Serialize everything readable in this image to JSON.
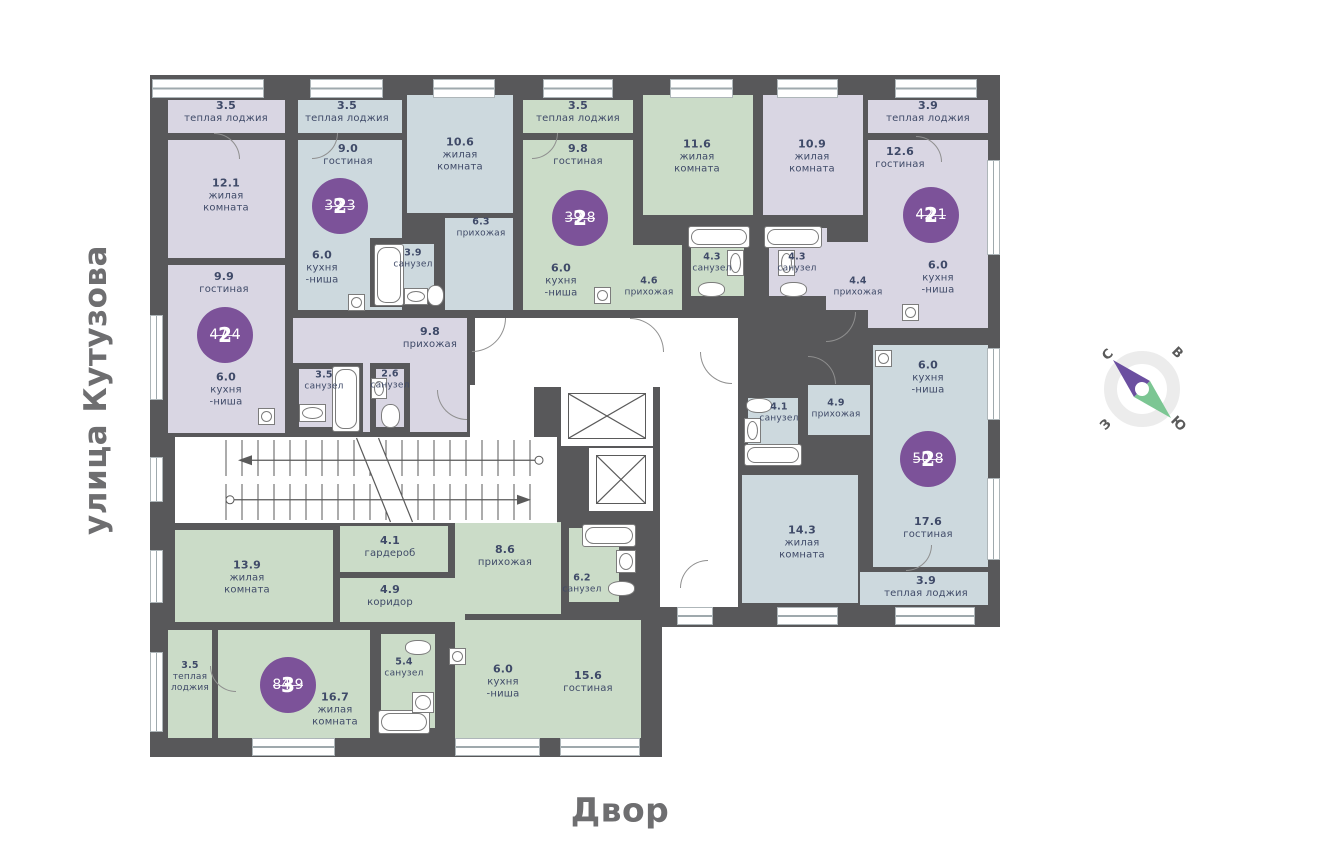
{
  "labels": {
    "street": "улица Кутузова",
    "courtyard": "Двор"
  },
  "compass": {
    "n": "С",
    "e": "В",
    "s": "Ю",
    "w": "З"
  },
  "colors": {
    "wall": "#58585a",
    "L": "#d9d6e3",
    "B": "#cdd9de",
    "G": "#cbdcc8",
    "W": "#ffffff",
    "badge": "#7c5299",
    "text": "#3f4a68",
    "street_text": "#6e6e70",
    "needle_north": "#6b4fa0",
    "needle_south": "#7cc693"
  },
  "apartments": [
    {
      "rooms": "2",
      "area": "47.4",
      "x": 225,
      "y": 335
    },
    {
      "rooms": "2",
      "area": "39.3",
      "x": 340,
      "y": 206
    },
    {
      "rooms": "2",
      "area": "39.8",
      "x": 580,
      "y": 218
    },
    {
      "rooms": "2",
      "area": "42.1",
      "x": 931,
      "y": 215
    },
    {
      "rooms": "2",
      "area": "50.8",
      "x": 928,
      "y": 459
    },
    {
      "rooms": "3",
      "area": "84.9",
      "x": 288,
      "y": 685
    }
  ],
  "building_blocks": [
    {
      "x": 150,
      "y": 75,
      "w": 850,
      "h": 552
    },
    {
      "x": 150,
      "y": 520,
      "w": 512,
      "h": 237
    }
  ],
  "rooms": [
    {
      "x": 168,
      "y": 100,
      "w": 117,
      "h": 33,
      "c": "L"
    },
    {
      "x": 168,
      "y": 140,
      "w": 117,
      "h": 118,
      "c": "L"
    },
    {
      "x": 168,
      "y": 265,
      "w": 117,
      "h": 168,
      "c": "L"
    },
    {
      "x": 293,
      "y": 318,
      "w": 174,
      "h": 114,
      "c": "L"
    },
    {
      "x": 293,
      "y": 363,
      "w": 70,
      "h": 70,
      "c": "L",
      "b": 1
    },
    {
      "x": 370,
      "y": 363,
      "w": 40,
      "h": 70,
      "c": "L",
      "b": 1
    },
    {
      "x": 763,
      "y": 95,
      "w": 100,
      "h": 120,
      "c": "L"
    },
    {
      "x": 763,
      "y": 222,
      "w": 70,
      "h": 80,
      "c": "L",
      "b": 1
    },
    {
      "x": 826,
      "y": 242,
      "w": 66,
      "h": 68,
      "c": "L"
    },
    {
      "x": 868,
      "y": 100,
      "w": 120,
      "h": 33,
      "c": "L"
    },
    {
      "x": 868,
      "y": 140,
      "w": 120,
      "h": 188,
      "c": "L"
    },
    {
      "x": 298,
      "y": 100,
      "w": 104,
      "h": 33,
      "c": "B"
    },
    {
      "x": 298,
      "y": 140,
      "w": 104,
      "h": 170,
      "c": "B"
    },
    {
      "x": 407,
      "y": 95,
      "w": 106,
      "h": 118,
      "c": "B"
    },
    {
      "x": 445,
      "y": 218,
      "w": 68,
      "h": 92,
      "c": "B"
    },
    {
      "x": 370,
      "y": 238,
      "w": 70,
      "h": 69,
      "c": "B",
      "b": 1
    },
    {
      "x": 873,
      "y": 345,
      "w": 115,
      "h": 222,
      "c": "B"
    },
    {
      "x": 808,
      "y": 385,
      "w": 62,
      "h": 50,
      "c": "B"
    },
    {
      "x": 742,
      "y": 392,
      "w": 62,
      "h": 76,
      "c": "B",
      "b": 1
    },
    {
      "x": 742,
      "y": 475,
      "w": 116,
      "h": 128,
      "c": "B"
    },
    {
      "x": 860,
      "y": 572,
      "w": 128,
      "h": 33,
      "c": "B"
    },
    {
      "x": 523,
      "y": 100,
      "w": 110,
      "h": 33,
      "c": "G"
    },
    {
      "x": 523,
      "y": 140,
      "w": 110,
      "h": 170,
      "c": "G"
    },
    {
      "x": 643,
      "y": 95,
      "w": 110,
      "h": 120,
      "c": "G"
    },
    {
      "x": 685,
      "y": 222,
      "w": 65,
      "h": 80,
      "c": "G",
      "b": 1
    },
    {
      "x": 610,
      "y": 245,
      "w": 72,
      "h": 65,
      "c": "G"
    },
    {
      "x": 175,
      "y": 530,
      "w": 158,
      "h": 92,
      "c": "G"
    },
    {
      "x": 340,
      "y": 526,
      "w": 108,
      "h": 46,
      "c": "G"
    },
    {
      "x": 340,
      "y": 578,
      "w": 125,
      "h": 44,
      "c": "G"
    },
    {
      "x": 168,
      "y": 630,
      "w": 44,
      "h": 108,
      "c": "G"
    },
    {
      "x": 218,
      "y": 630,
      "w": 152,
      "h": 108,
      "c": "G"
    },
    {
      "x": 375,
      "y": 628,
      "w": 66,
      "h": 106,
      "c": "G",
      "b": 1
    },
    {
      "x": 455,
      "y": 522,
      "w": 106,
      "h": 92,
      "c": "G"
    },
    {
      "x": 563,
      "y": 522,
      "w": 62,
      "h": 86,
      "c": "G",
      "b": 1
    },
    {
      "x": 455,
      "y": 620,
      "w": 186,
      "h": 118,
      "c": "G"
    },
    {
      "x": 475,
      "y": 318,
      "w": 263,
      "h": 69,
      "c": "W"
    },
    {
      "x": 470,
      "y": 385,
      "w": 64,
      "h": 52,
      "c": "W"
    },
    {
      "x": 175,
      "y": 437,
      "w": 382,
      "h": 86,
      "c": "W"
    },
    {
      "x": 660,
      "y": 387,
      "w": 78,
      "h": 220,
      "c": "W"
    }
  ],
  "room_labels": [
    {
      "x": 226,
      "y": 112,
      "area": "3.5",
      "name": "теплая лоджия"
    },
    {
      "x": 226,
      "y": 196,
      "area": "12.1",
      "name": "жилая\nкомната"
    },
    {
      "x": 224,
      "y": 283,
      "area": "9.9",
      "name": "гостиная"
    },
    {
      "x": 226,
      "y": 390,
      "area": "6.0",
      "name": "кухня\n-ниша"
    },
    {
      "x": 430,
      "y": 338,
      "area": "9.8",
      "name": "прихожая"
    },
    {
      "x": 324,
      "y": 381,
      "area": "3.5",
      "name": "санузел",
      "s": 1
    },
    {
      "x": 390,
      "y": 380,
      "area": "2.6",
      "name": "санузел",
      "s": 1
    },
    {
      "x": 347,
      "y": 112,
      "area": "3.5",
      "name": "теплая лоджия"
    },
    {
      "x": 348,
      "y": 155,
      "area": "9.0",
      "name": "гостиная"
    },
    {
      "x": 322,
      "y": 268,
      "area": "6.0",
      "name": "кухня\n-ниша"
    },
    {
      "x": 413,
      "y": 259,
      "area": "3.9",
      "name": "санузел",
      "s": 1
    },
    {
      "x": 460,
      "y": 155,
      "area": "10.6",
      "name": "жилая\nкомната"
    },
    {
      "x": 481,
      "y": 228,
      "area": "6.3",
      "name": "прихожая",
      "s": 1
    },
    {
      "x": 578,
      "y": 112,
      "area": "3.5",
      "name": "теплая лоджия"
    },
    {
      "x": 578,
      "y": 155,
      "area": "9.8",
      "name": "гостиная"
    },
    {
      "x": 561,
      "y": 281,
      "area": "6.0",
      "name": "кухня\n-ниша"
    },
    {
      "x": 649,
      "y": 287,
      "area": "4.6",
      "name": "прихожая",
      "s": 1
    },
    {
      "x": 712,
      "y": 263,
      "area": "4.3",
      "name": "санузел",
      "s": 1
    },
    {
      "x": 697,
      "y": 157,
      "area": "11.6",
      "name": "жилая\nкомната"
    },
    {
      "x": 812,
      "y": 157,
      "area": "10.9",
      "name": "жилая\nкомната"
    },
    {
      "x": 797,
      "y": 263,
      "area": "4.3",
      "name": "санузел",
      "s": 1
    },
    {
      "x": 858,
      "y": 287,
      "area": "4.4",
      "name": "прихожая",
      "s": 1
    },
    {
      "x": 928,
      "y": 112,
      "area": "3.9",
      "name": "теплая лоджия"
    },
    {
      "x": 900,
      "y": 158,
      "area": "12.6",
      "name": "гостиная"
    },
    {
      "x": 938,
      "y": 278,
      "area": "6.0",
      "name": "кухня\n-ниша"
    },
    {
      "x": 928,
      "y": 378,
      "area": "6.0",
      "name": "кухня\n-ниша"
    },
    {
      "x": 836,
      "y": 409,
      "area": "4.9",
      "name": "прихожая",
      "s": 1
    },
    {
      "x": 779,
      "y": 413,
      "area": "4.1",
      "name": "санузел",
      "s": 1
    },
    {
      "x": 802,
      "y": 543,
      "area": "14.3",
      "name": "жилая\nкомната"
    },
    {
      "x": 928,
      "y": 528,
      "area": "17.6",
      "name": "гостиная"
    },
    {
      "x": 926,
      "y": 587,
      "area": "3.9",
      "name": "теплая лоджия"
    },
    {
      "x": 247,
      "y": 578,
      "area": "13.9",
      "name": "жилая\nкомната"
    },
    {
      "x": 390,
      "y": 547,
      "area": "4.1",
      "name": "гардероб"
    },
    {
      "x": 390,
      "y": 596,
      "area": "4.9",
      "name": "коридор"
    },
    {
      "x": 190,
      "y": 677,
      "area": "3.5",
      "name": "теплая\nлоджия",
      "s": 1
    },
    {
      "x": 335,
      "y": 710,
      "area": "16.7",
      "name": "жилая\nкомната"
    },
    {
      "x": 404,
      "y": 668,
      "area": "5.4",
      "name": "санузел",
      "s": 1
    },
    {
      "x": 505,
      "y": 556,
      "area": "8.6",
      "name": "прихожая"
    },
    {
      "x": 582,
      "y": 584,
      "area": "6.2",
      "name": "санузел",
      "s": 1
    },
    {
      "x": 503,
      "y": 682,
      "area": "6.0",
      "name": "кухня\n-ниша"
    },
    {
      "x": 588,
      "y": 682,
      "area": "15.6",
      "name": "гостиная"
    }
  ],
  "windows": [
    {
      "x": 152,
      "y": 79,
      "w": 112,
      "h": 19
    },
    {
      "x": 310,
      "y": 79,
      "w": 73,
      "h": 19
    },
    {
      "x": 433,
      "y": 79,
      "w": 62,
      "h": 19
    },
    {
      "x": 543,
      "y": 79,
      "w": 70,
      "h": 19
    },
    {
      "x": 670,
      "y": 79,
      "w": 63,
      "h": 19
    },
    {
      "x": 777,
      "y": 79,
      "w": 61,
      "h": 19
    },
    {
      "x": 895,
      "y": 79,
      "w": 82,
      "h": 19
    },
    {
      "x": 150,
      "y": 315,
      "w": 13,
      "h": 85
    },
    {
      "x": 150,
      "y": 457,
      "w": 13,
      "h": 45
    },
    {
      "x": 150,
      "y": 550,
      "w": 13,
      "h": 53
    },
    {
      "x": 150,
      "y": 652,
      "w": 13,
      "h": 80
    },
    {
      "x": 987,
      "y": 160,
      "w": 13,
      "h": 95
    },
    {
      "x": 987,
      "y": 348,
      "w": 13,
      "h": 72
    },
    {
      "x": 987,
      "y": 478,
      "w": 13,
      "h": 82
    },
    {
      "x": 677,
      "y": 607,
      "w": 36,
      "h": 18
    },
    {
      "x": 777,
      "y": 607,
      "w": 61,
      "h": 18
    },
    {
      "x": 895,
      "y": 607,
      "w": 80,
      "h": 18
    },
    {
      "x": 252,
      "y": 738,
      "w": 83,
      "h": 18
    },
    {
      "x": 455,
      "y": 738,
      "w": 85,
      "h": 18
    },
    {
      "x": 560,
      "y": 738,
      "w": 80,
      "h": 18
    }
  ],
  "elevators": [
    {
      "x": 568,
      "y": 393,
      "w": 78,
      "h": 46
    },
    {
      "x": 596,
      "y": 455,
      "w": 50,
      "h": 49
    }
  ],
  "stairs": {
    "x": 212,
    "y": 437,
    "w": 345,
    "h": 86
  },
  "fixtures": [
    {
      "x": 374,
      "y": 244,
      "w": 30,
      "h": 62,
      "t": "tub"
    },
    {
      "x": 688,
      "y": 226,
      "w": 62,
      "h": 22,
      "t": "tub"
    },
    {
      "x": 764,
      "y": 226,
      "w": 58,
      "h": 22,
      "t": "tub"
    },
    {
      "x": 332,
      "y": 366,
      "w": 28,
      "h": 66,
      "t": "tub"
    },
    {
      "x": 744,
      "y": 444,
      "w": 58,
      "h": 22,
      "t": "tub"
    },
    {
      "x": 378,
      "y": 710,
      "w": 52,
      "h": 24,
      "t": "tub"
    },
    {
      "x": 582,
      "y": 524,
      "w": 54,
      "h": 23,
      "t": "tub"
    },
    {
      "x": 404,
      "y": 288,
      "w": 24,
      "h": 17,
      "t": "sink"
    },
    {
      "x": 727,
      "y": 250,
      "w": 17,
      "h": 26,
      "t": "sink"
    },
    {
      "x": 778,
      "y": 250,
      "w": 17,
      "h": 26,
      "t": "sink"
    },
    {
      "x": 299,
      "y": 404,
      "w": 27,
      "h": 18,
      "t": "sink"
    },
    {
      "x": 371,
      "y": 378,
      "w": 16,
      "h": 21,
      "t": "sink"
    },
    {
      "x": 744,
      "y": 418,
      "w": 17,
      "h": 25,
      "t": "sink"
    },
    {
      "x": 412,
      "y": 692,
      "w": 22,
      "h": 21,
      "t": "sink"
    },
    {
      "x": 616,
      "y": 550,
      "w": 20,
      "h": 23,
      "t": "sink"
    },
    {
      "x": 427,
      "y": 285,
      "w": 17,
      "h": 21,
      "t": "toilet"
    },
    {
      "x": 698,
      "y": 282,
      "w": 27,
      "h": 15,
      "t": "toilet"
    },
    {
      "x": 780,
      "y": 282,
      "w": 27,
      "h": 15,
      "t": "toilet"
    },
    {
      "x": 381,
      "y": 404,
      "w": 19,
      "h": 24,
      "t": "toilet"
    },
    {
      "x": 746,
      "y": 398,
      "w": 26,
      "h": 15,
      "t": "toilet"
    },
    {
      "x": 405,
      "y": 640,
      "w": 26,
      "h": 15,
      "t": "toilet"
    },
    {
      "x": 608,
      "y": 581,
      "w": 27,
      "h": 15,
      "t": "toilet"
    },
    {
      "x": 348,
      "y": 294,
      "w": 17,
      "h": 17,
      "t": "washer"
    },
    {
      "x": 258,
      "y": 408,
      "w": 17,
      "h": 17,
      "t": "washer"
    },
    {
      "x": 594,
      "y": 287,
      "w": 17,
      "h": 17,
      "t": "washer"
    },
    {
      "x": 902,
      "y": 304,
      "w": 17,
      "h": 17,
      "t": "washer"
    },
    {
      "x": 875,
      "y": 350,
      "w": 17,
      "h": 17,
      "t": "washer"
    },
    {
      "x": 449,
      "y": 648,
      "w": 17,
      "h": 17,
      "t": "washer"
    }
  ],
  "doors": [
    {
      "x": 472,
      "y": 318,
      "r": 34,
      "rot": 90
    },
    {
      "x": 630,
      "y": 318,
      "r": 34,
      "rot": 0
    },
    {
      "x": 826,
      "y": 312,
      "r": 30,
      "rot": 90
    },
    {
      "x": 700,
      "y": 352,
      "r": 32,
      "rot": 180
    },
    {
      "x": 437,
      "y": 390,
      "r": 30,
      "rot": 180
    },
    {
      "x": 808,
      "y": 356,
      "r": 28,
      "rot": 0
    },
    {
      "x": 680,
      "y": 560,
      "r": 28,
      "rot": 270
    },
    {
      "x": 214,
      "y": 133,
      "r": 26,
      "rot": 0
    },
    {
      "x": 312,
      "y": 133,
      "r": 26,
      "rot": 90
    },
    {
      "x": 532,
      "y": 133,
      "r": 26,
      "rot": 90
    },
    {
      "x": 916,
      "y": 136,
      "r": 26,
      "rot": 0
    },
    {
      "x": 906,
      "y": 545,
      "r": 26,
      "rot": 90
    },
    {
      "x": 210,
      "y": 666,
      "r": 26,
      "rot": 180
    }
  ]
}
